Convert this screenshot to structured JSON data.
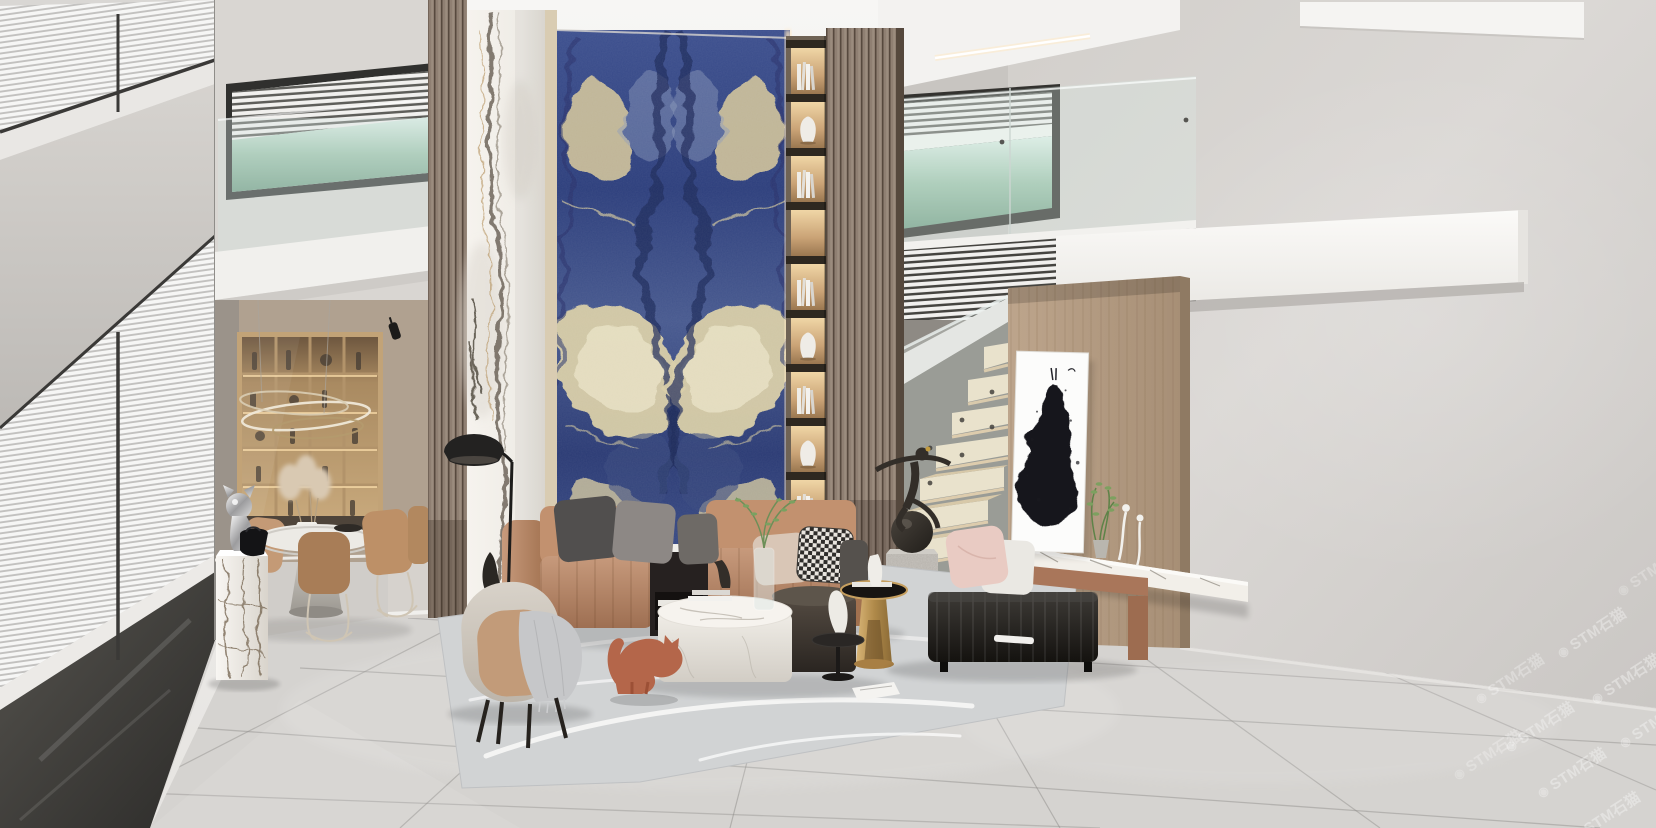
{
  "meta": {
    "description": "Photorealistic 3D render: double-height modern showroom living room with bookmatched blue sodalite marble feature wall, calacatta column, wood slat screens, backlit shelving niches, floating stair, mezzanine with glass balustrade, dining nook and tan leather seating group",
    "render_type": "interior-visualization",
    "canvas": {
      "width": 1656,
      "height": 828
    }
  },
  "watermark": {
    "icon": "◉",
    "text": "STM石猫",
    "instances": 9,
    "placement": "diagonal repeat, bottom-right corner, semi-transparent"
  },
  "palette": {
    "ceiling": "#f3f2f0",
    "wall_gray": "#d6d3d0",
    "floor_tile": "#d3d1ce",
    "blue_marble_deep": "#24306a",
    "blue_marble_mid": "#3c4f8e",
    "cream_vein": "#d6cba3",
    "calacatta_white": "#f3f0eb",
    "wood_slat": "#8f7f72",
    "wood_panel": "#b49c84",
    "leather_tan": "#b9886c",
    "charcoal": "#26241f",
    "warm_glow": "#ffd9a2",
    "terracotta_cat": "#b4664a",
    "glass_tint": "#d9e8e4",
    "stair_tread": "#e9d9b8"
  },
  "scene": {
    "areas": [
      {
        "name": "left-window-wall",
        "label": "double-height glazing with white venetian blinds"
      },
      {
        "name": "dining-nook",
        "label": "round table, tan chairs, backlit wine cabinet, ring chandelier, marble pedestal with chrome cat bust and black handbag"
      },
      {
        "name": "feature-walls",
        "label": "calacatta column, bookmatched blue sodalite slab, backlit book niches, walnut slat screens"
      },
      {
        "name": "mezzanine",
        "label": "glass balustrade, picture windows to hills, louvered white fascia and cantilevered beam"
      },
      {
        "name": "stair",
        "label": "floating timber treads with under-tread LED and glass rail"
      },
      {
        "name": "tv-wall",
        "label": "wood veneer wall, floating marble ledge, ink-dress artwork, plant, wire figurines"
      },
      {
        "name": "living-group",
        "label": "tan leather sectional, gray pillows, houndstooth pillow, bouclé armchair with throw, marble and bronze drum coffee tables, gold side table, black channel-tufted bench, terracotta cat figurine, gray art rug"
      }
    ]
  }
}
